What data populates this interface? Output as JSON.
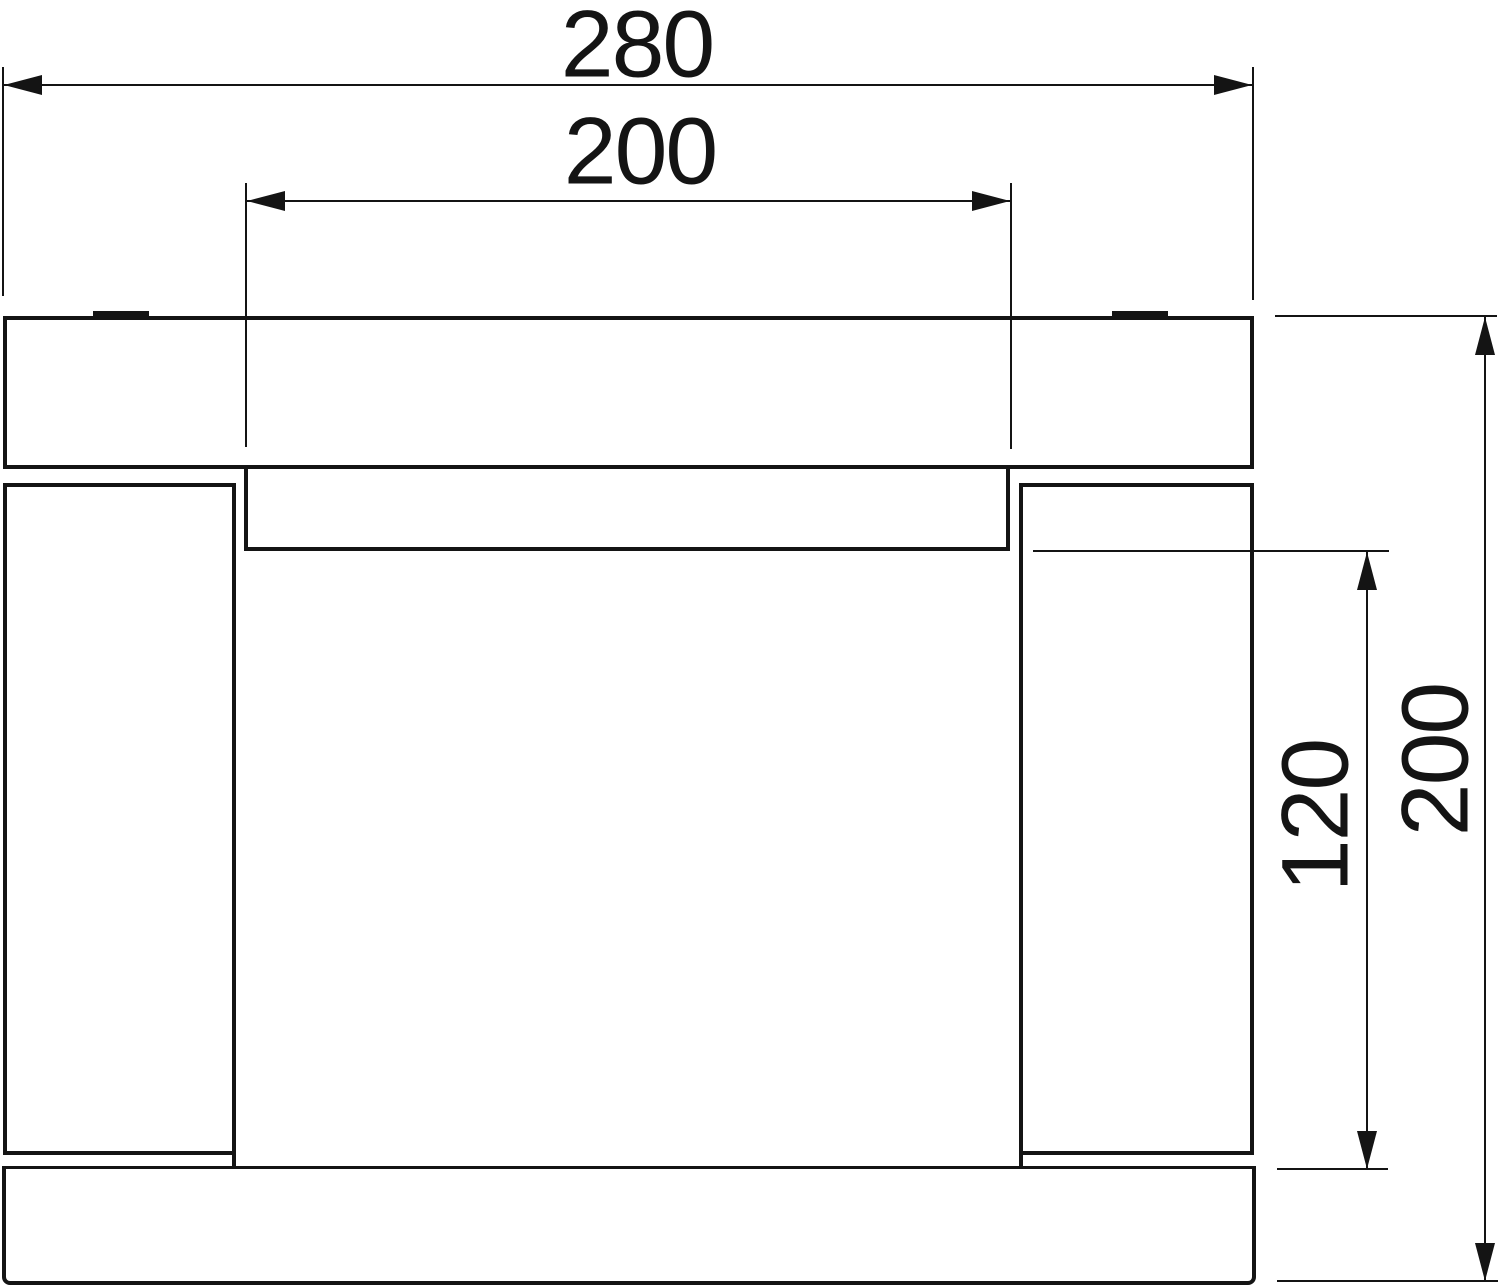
{
  "drawing": {
    "background": "#ffffff",
    "line_color": "#141414",
    "type": "cross-section technical drawing of channel profile with cover"
  },
  "dims": {
    "overall_width": {
      "label": "280"
    },
    "opening_width": {
      "label": "200"
    },
    "inner_depth": {
      "label": "120"
    },
    "overall_height": {
      "label": "200"
    }
  }
}
